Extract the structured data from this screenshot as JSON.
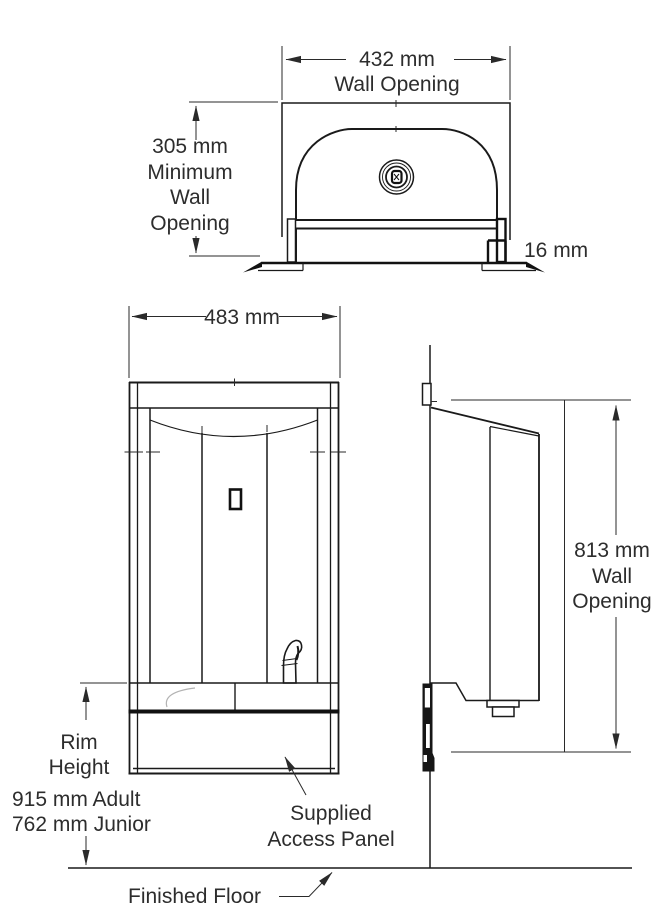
{
  "drawing": {
    "type": "semi-recessed drinking fountain installation drawing",
    "views": [
      "top-section-view",
      "front-view",
      "side-view"
    ],
    "colors": {
      "line": "#1a1a1a",
      "text": "#2d2d2d",
      "background": "#ffffff"
    }
  },
  "labels": {
    "wall_opening_width": {
      "value": "432 mm",
      "caption": "Wall Opening"
    },
    "min_wall_opening": {
      "l1": "305 mm",
      "l2": "Minimum",
      "l3": "Wall",
      "l4": "Opening"
    },
    "flange_offset": {
      "value": "16 mm"
    },
    "unit_width": {
      "value": "483 mm"
    },
    "wall_opening_height": {
      "l1": "813 mm",
      "l2": "Wall",
      "l3": "Opening"
    },
    "rim_height": {
      "l1": "Rim",
      "l2": "Height",
      "adult": "915 mm Adult",
      "junior": "762 mm Junior"
    },
    "access_panel": {
      "l1": "Supplied",
      "l2": "Access Panel"
    },
    "finished_floor": {
      "value": "Finished Floor"
    }
  }
}
